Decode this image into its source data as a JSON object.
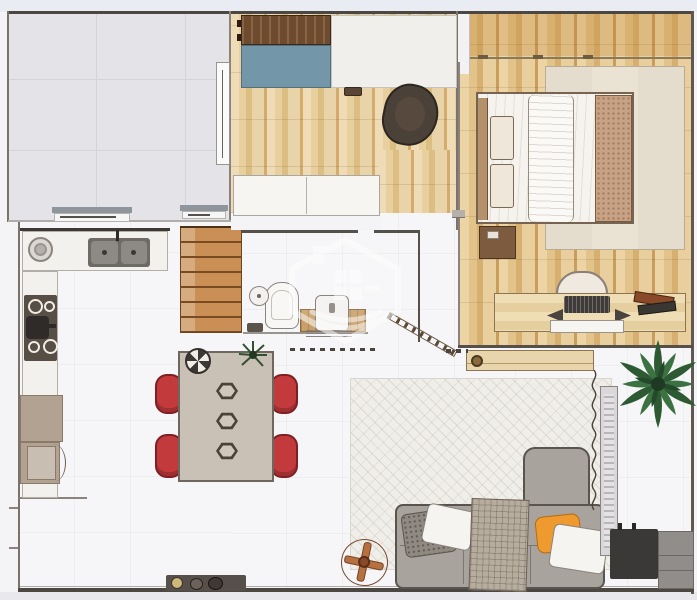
{
  "scene": {
    "type": "architectural-floorplan-render",
    "description": "Top-down 3D rendered apartment floor plan",
    "watermark_icon": "house-logo-watermark"
  },
  "palette": {
    "canvas": "#f4f4f7",
    "outside_top": "#e9edf3",
    "outside_bottom": "#e9e8ed",
    "floor_white": "#f6f5f7",
    "tile": "#e4e3e7",
    "tile_line": "#d4d3d8",
    "wall_dark": "#4d4741",
    "wall_mid": "#7a736c",
    "wall_light": "#b0aca8",
    "walnut": "#6e4a2f",
    "blue_panel": "#7396a9",
    "chair_red": "#c23a3c",
    "chair_red_dark": "#7e2023",
    "table_top": "#c9c0b6",
    "sofa_gray": "#a9a39d",
    "sofa_outline": "#5a544e",
    "pillow_orange": "#ef9a2e",
    "rug_living": "#f0eee8",
    "rug_bed": "#eae2d3",
    "plant_green": "#2e5a33",
    "plant_green_dark": "#24492a",
    "copper": "#b5713f",
    "taupe_cab": "#b2a292",
    "tv_dark": "#3b3937",
    "cabinet_gray": "#908d8b",
    "door_wood": "#c98f55",
    "door_wood_line": "#7a4a22",
    "blanket_tan": "#c7a284",
    "counter_white": "#f3f1ee",
    "counter_edge": "#b3aea8",
    "cooktop_dark": "#574e45",
    "sink_gray": "#6e6a66",
    "watermark_white": "#ffffff"
  },
  "rooms": [
    {
      "id": "tiled-room",
      "label": "Empty tiled room"
    },
    {
      "id": "home-office",
      "label": "Home office"
    },
    {
      "id": "bedroom",
      "label": "Bedroom"
    },
    {
      "id": "kitchen",
      "label": "Kitchen"
    },
    {
      "id": "bathroom",
      "label": "Bathroom"
    },
    {
      "id": "dining-area",
      "label": "Dining area"
    },
    {
      "id": "living-room",
      "label": "Living room"
    }
  ],
  "furniture": {
    "home_office": [
      "walnut overhead cabinet",
      "blue desk panel",
      "white desk",
      "office chair",
      "white sideboard"
    ],
    "bedroom": [
      "double bed",
      "headboard",
      "tan blanket",
      "area rug",
      "nightstand",
      "wood desk",
      "desk chair",
      "laptop",
      "books",
      "under-desk drawer"
    ],
    "kitchen": [
      "counter with double sink",
      "round plate",
      "cooktop with pot",
      "tall counter",
      "pantry cabinet",
      "open dishwasher"
    ],
    "bathroom": [
      "toilet",
      "toilet paper holder",
      "vanity sink",
      "wood backsplash",
      "floor drain"
    ],
    "dining": [
      "dining table",
      "red chair",
      "hex placemat",
      "fruit bowl",
      "table plant"
    ],
    "living": [
      "area rug",
      "l-shaped sofa",
      "gray pillow",
      "white pillow",
      "plaid throw",
      "orange pillow",
      "potted plant",
      "tv console",
      "media cabinet",
      "floor fan",
      "window radiator",
      "wood console shelf",
      "doormat",
      "cable"
    ],
    "misc": [
      "wood sliding door",
      "glass door",
      "diagonal railing",
      "wall vent",
      "watermark house logo"
    ]
  }
}
